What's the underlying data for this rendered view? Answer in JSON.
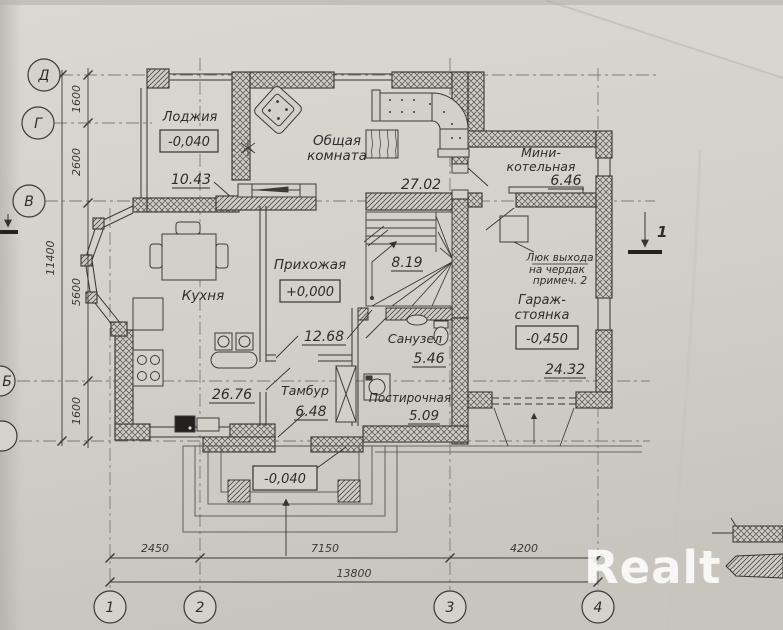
{
  "colors": {
    "paper": "#d3d0ca",
    "ink": "#35342f",
    "axis_line": "#7a7a78",
    "watermark": "rgba(255,255,255,0.85)"
  },
  "watermark": "Realt",
  "axes": {
    "rows": [
      "Д",
      "Г",
      "В",
      "Б"
    ],
    "cols": [
      "1",
      "2",
      "3",
      "4"
    ]
  },
  "dims": {
    "left": [
      "1600",
      "2600",
      "5600",
      "1600"
    ],
    "left_total": "11400",
    "bottom": [
      "2450",
      "7150",
      "4200"
    ],
    "bottom_total": "13800"
  },
  "rooms": {
    "loggia": {
      "name": "Лоджия",
      "level": "-0,040",
      "area": "10.43"
    },
    "living": {
      "name": "Общая комната",
      "name_lines": [
        "Общая",
        "комната"
      ],
      "area": "27.02"
    },
    "boiler": {
      "name": "Мини-котельная",
      "name_lines": [
        "Мини-",
        "котельная"
      ],
      "area": "6.46"
    },
    "kitchen": {
      "name": "Кухня",
      "area": "26.76"
    },
    "hall": {
      "name": "Прихожая",
      "level": "+0,000",
      "area": "12.68"
    },
    "stairs": {
      "area": "8.19"
    },
    "bathroom": {
      "name": "Санузел",
      "area": "5.46"
    },
    "vestibule": {
      "name": "Тамбур",
      "area": "6.48"
    },
    "laundry": {
      "name": "Постирочная",
      "area": "5.09"
    },
    "garage": {
      "name": "Гараж-стоянка",
      "name_lines": [
        "Гараж-",
        "стоянка"
      ],
      "level": "-0,450",
      "area": "24.32"
    },
    "porch": {
      "level": "-0,040"
    }
  },
  "notes": {
    "attic_hatch": "Люк выхода на чердак примеч. 2",
    "attic_hatch_lines": [
      "Люк выхода",
      "на чердак",
      "примеч. 2"
    ],
    "section_mark": "1"
  }
}
